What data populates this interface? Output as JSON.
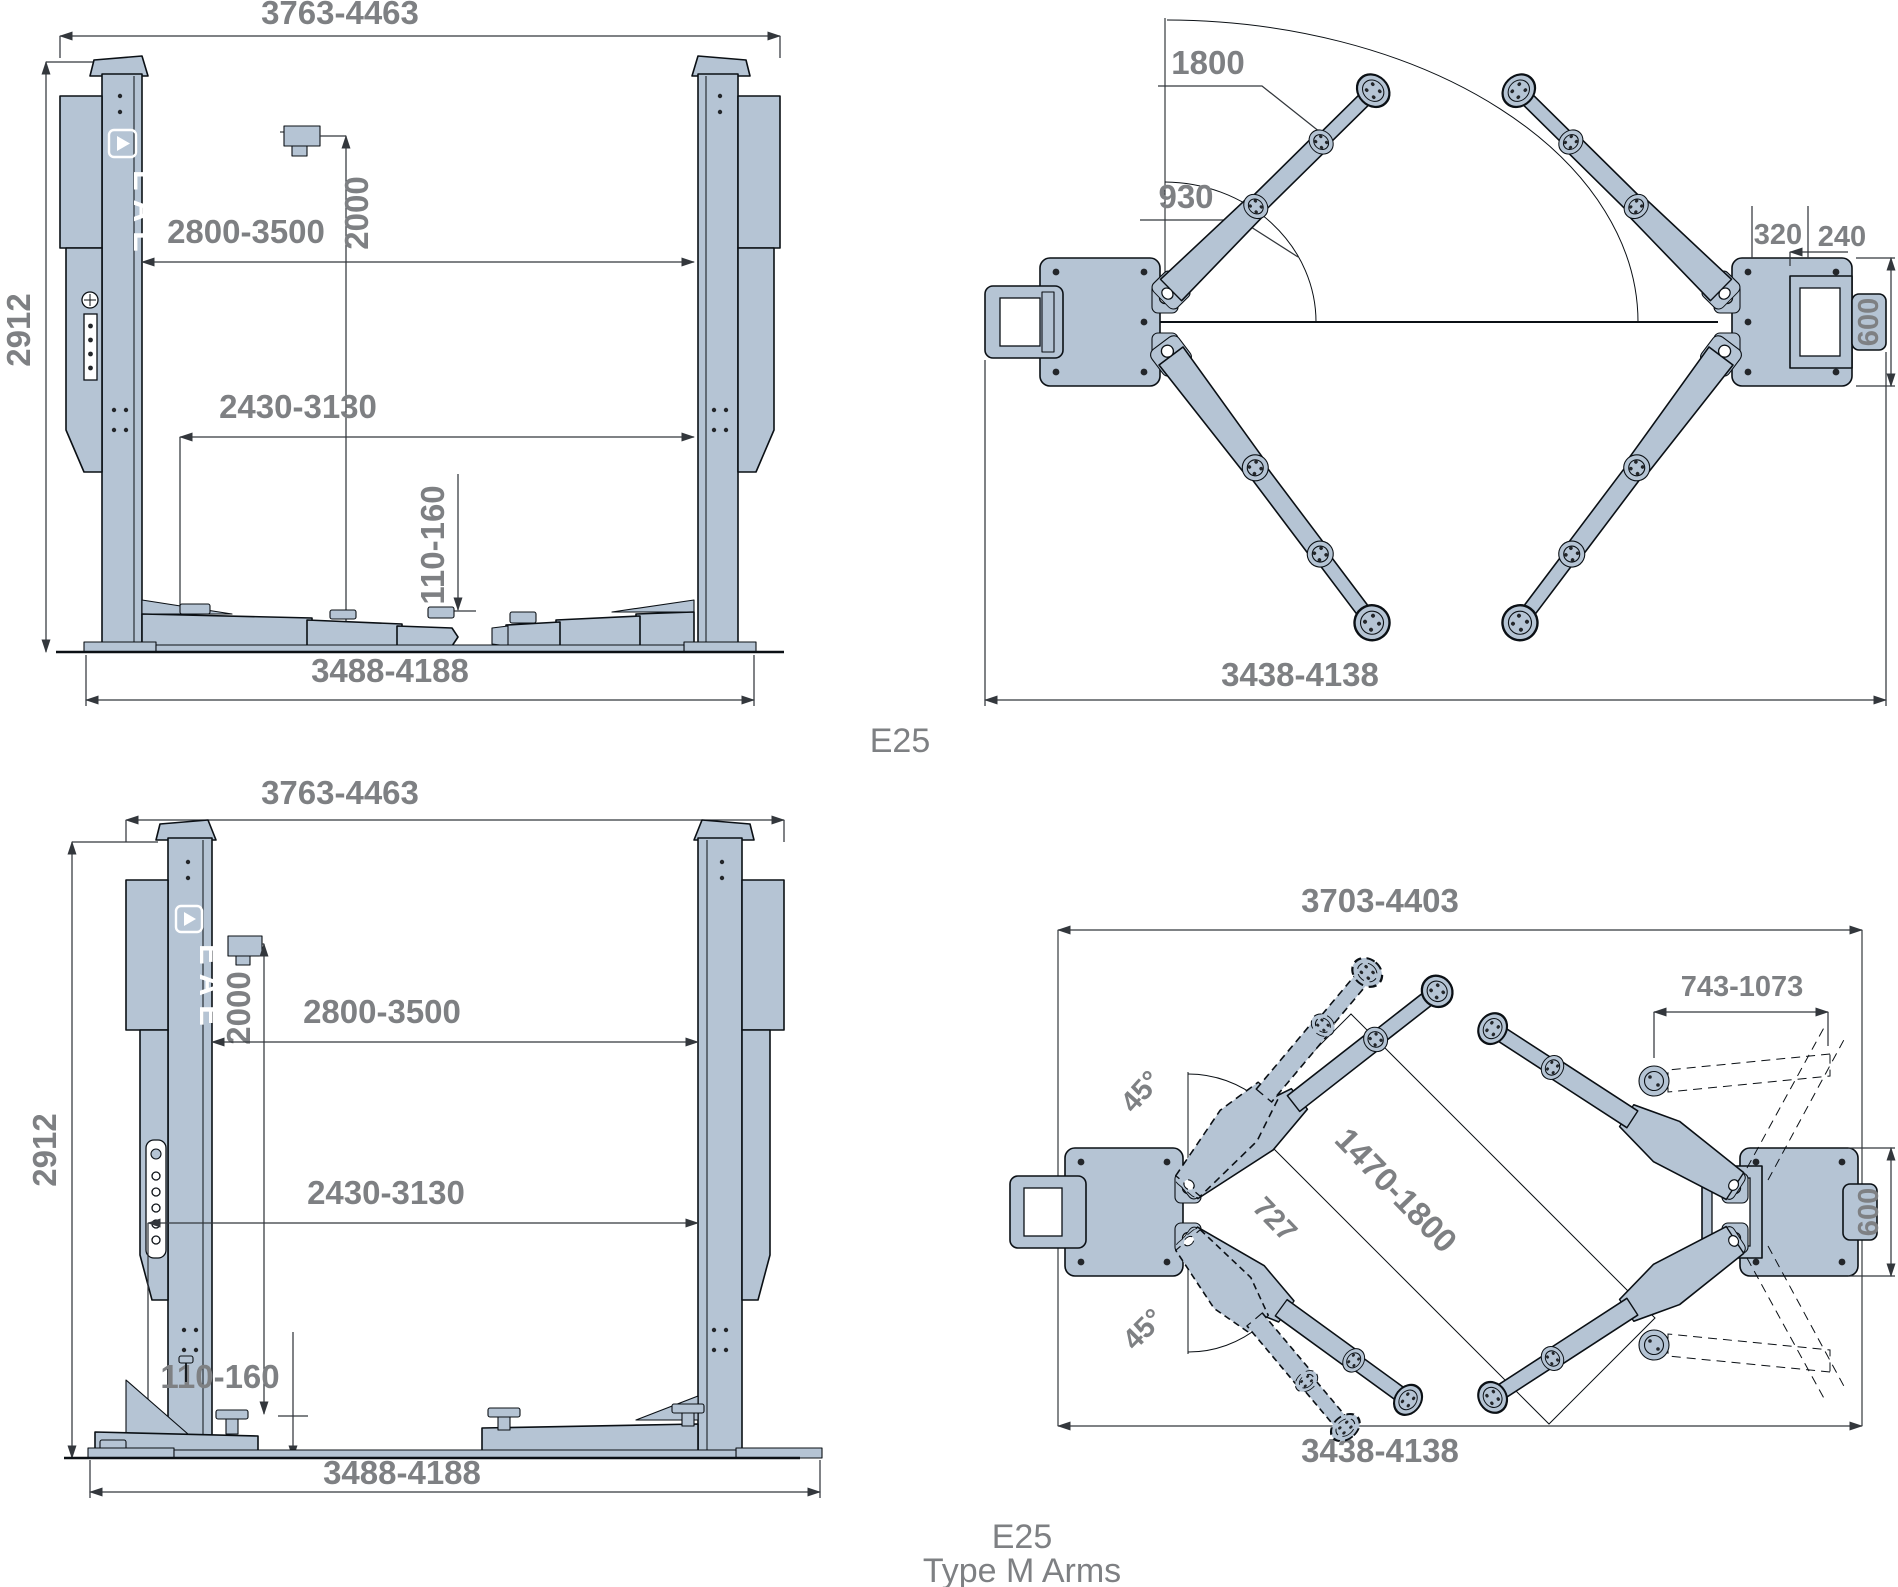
{
  "brand": {
    "name": "EAE"
  },
  "captions": {
    "top_model": "E25",
    "bottom_model": "E25",
    "bottom_variant": "Type M Arms"
  },
  "colors": {
    "steel": "#b5c4d4",
    "dim_text": "#7e8083",
    "line": "#0b1015"
  },
  "front_view_top": {
    "overall_width": "3763-4463",
    "column_height": "2912",
    "clear_width_upper": "2800-3500",
    "photocell_height": "2000",
    "clear_width_lower": "2430-3130",
    "pad_height": "110-160",
    "base_width": "3488-4188"
  },
  "plan_view_top": {
    "reach_max": "1800",
    "reach_min": "930",
    "anchor_offset": "320",
    "anchor_spacing": "240",
    "base_plate_depth": "600",
    "outer_width": "3438-4138"
  },
  "front_view_bottom": {
    "overall_width": "3763-4463",
    "column_height": "2912",
    "clear_width_upper": "2800-3500",
    "photocell_height": "2000",
    "clear_width_lower": "2430-3130",
    "pad_height": "110-160",
    "base_width": "3488-4188"
  },
  "plan_view_bottom": {
    "overall_width": "3703-4403",
    "arm_extension": "743-1073",
    "swing_angle_upper": "45°",
    "swing_angle_lower": "45°",
    "arm_reach_min": "727",
    "arm_reach_range": "1470-1800",
    "base_plate_depth": "600",
    "outer_width": "3438-4138"
  }
}
